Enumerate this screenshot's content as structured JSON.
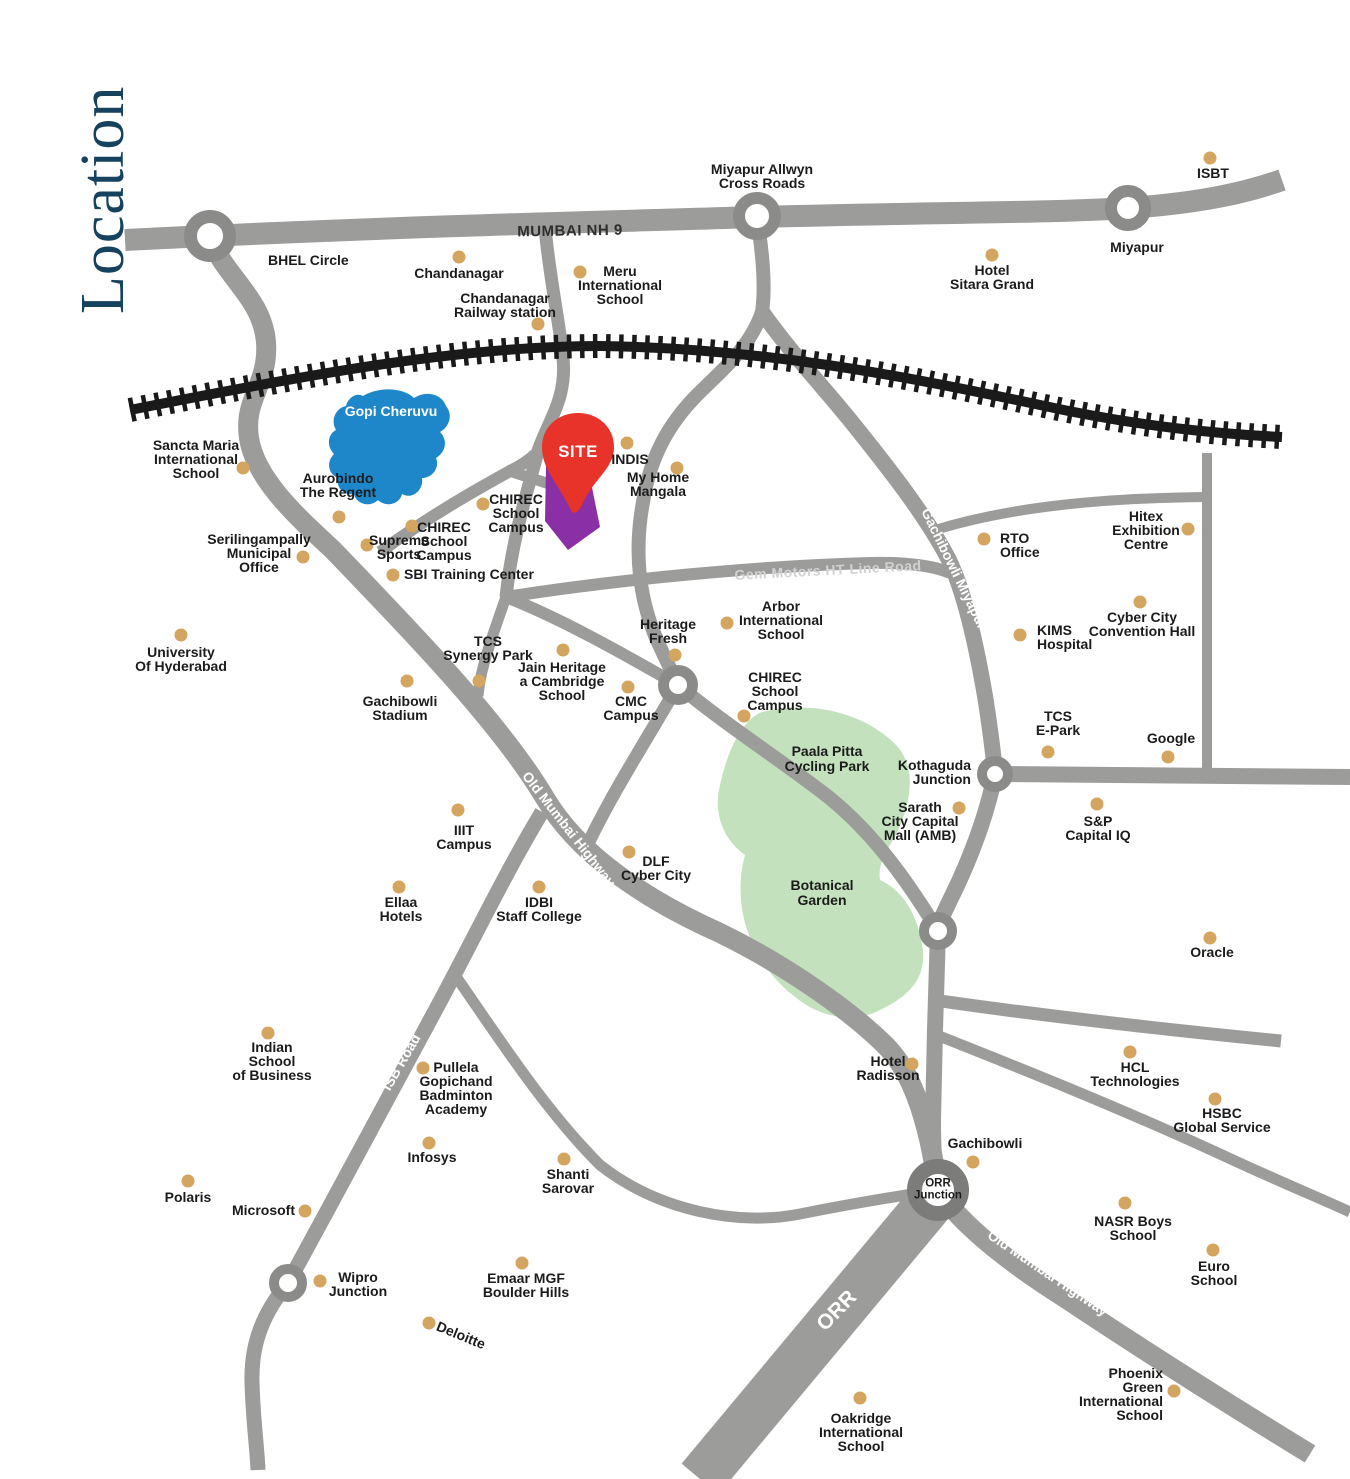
{
  "title": "Location",
  "colors": {
    "road": "#9c9c9b",
    "ring_stroke": "#8b8b8a",
    "railway": "#1a1a1a",
    "lake": "#1d87ca",
    "park": "#c3e1bd",
    "poi_dot": "#d3a55f",
    "site_pin": "#e8332a",
    "site_plot": "#8a2fa5",
    "title_navy": "#16425d"
  },
  "site": {
    "label": "SITE"
  },
  "water": {
    "label": "Gopi Cheruvu",
    "x": 391,
    "y": 404
  },
  "parks": [
    {
      "label": "Paala Pitta\nCycling Park",
      "x": 827,
      "y": 744
    },
    {
      "label": "Botanical\nGarden",
      "x": 822,
      "y": 878
    }
  ],
  "road_labels": [
    {
      "text": "MUMBAI NH 9",
      "x": 570,
      "y": 231,
      "rot": -1,
      "style": "dark",
      "size": 15
    },
    {
      "text": "150 Ft Road",
      "x": 531,
      "y": 416,
      "rot": -74,
      "style": "light",
      "size": 13.5
    },
    {
      "text": "Road No 9",
      "x": 472,
      "y": 478,
      "rot": -27,
      "style": "light",
      "size": 13.5
    },
    {
      "text": "Gem Motors HT Line Road",
      "x": 828,
      "y": 570,
      "rot": -3,
      "style": "faint",
      "size": 14
    },
    {
      "text": "Gachibowli Miyapur Road",
      "x": 963,
      "y": 586,
      "rot": 64,
      "style": "light",
      "size": 14
    },
    {
      "text": "Old Mumbai Highway",
      "x": 569,
      "y": 829,
      "rot": 52,
      "style": "light",
      "size": 14
    },
    {
      "text": "ISB Road",
      "x": 401,
      "y": 1062,
      "rot": -60,
      "style": "light",
      "size": 14
    },
    {
      "text": "ORR",
      "x": 837,
      "y": 1311,
      "rot": -46,
      "style": "light",
      "size": 21
    },
    {
      "text": "Old Mumbai Highway",
      "x": 1048,
      "y": 1273,
      "rot": 34,
      "style": "light",
      "size": 14
    }
  ],
  "junctions": [
    {
      "name": "bhel-circle",
      "x": 210,
      "y": 236,
      "od": 52,
      "bw": 13,
      "label": "BHEL Circle",
      "lx": 268,
      "ly": 253,
      "align": "left"
    },
    {
      "name": "miyapur-allwyn-cross-roads",
      "x": 757,
      "y": 216,
      "od": 48,
      "bw": 12,
      "label": "Miyapur Allwyn\nCross Roads",
      "lx": 762,
      "ly": 162,
      "align": "center"
    },
    {
      "name": "miyapur",
      "x": 1128,
      "y": 208,
      "od": 46,
      "bw": 12,
      "label": "Miyapur",
      "lx": 1137,
      "ly": 240,
      "align": "center"
    },
    {
      "name": "heritage-fresh-junction",
      "x": 678,
      "y": 685,
      "od": 40,
      "bw": 11,
      "label": null
    },
    {
      "name": "kothaguda-junction",
      "x": 995,
      "y": 774,
      "od": 36,
      "bw": 10,
      "label": "Kothaguda\nJunction",
      "lx": 971,
      "ly": 758,
      "align": "right"
    },
    {
      "name": "botanical-junction",
      "x": 938,
      "y": 931,
      "od": 38,
      "bw": 10,
      "label": null
    },
    {
      "name": "wipro-junction-ring",
      "x": 288,
      "y": 1283,
      "od": 38,
      "bw": 10,
      "label": null
    },
    {
      "name": "orr-junction",
      "x": 938,
      "y": 1190,
      "od": 62,
      "bw": 15,
      "label": null,
      "label_inside": "ORR\nJunction"
    }
  ],
  "pois": [
    {
      "label": "Chandanagar",
      "dot": [
        459,
        257
      ],
      "lx": 459,
      "ly": 266,
      "align": "center"
    },
    {
      "label": "Meru\nInternational\nSchool",
      "dot": [
        580,
        272
      ],
      "lx": 620,
      "ly": 264,
      "align": "center"
    },
    {
      "label": "Chandanagar\nRailway station",
      "dot": [
        538,
        324
      ],
      "lx": 505,
      "ly": 291,
      "align": "center"
    },
    {
      "label": "Hotel\nSitara Grand",
      "dot": [
        992,
        255
      ],
      "lx": 992,
      "ly": 263,
      "align": "center"
    },
    {
      "label": "ISBT",
      "dot": [
        1210,
        158
      ],
      "lx": 1213,
      "ly": 166,
      "align": "center"
    },
    {
      "label": "Sancta Maria\nInternational\nSchool",
      "dot": [
        243,
        468
      ],
      "lx": 196,
      "ly": 438,
      "align": "center"
    },
    {
      "label": "Aurobindo\nThe Regent",
      "dot": [
        339,
        517
      ],
      "lx": 338,
      "ly": 471,
      "align": "center"
    },
    {
      "label": "Supreme\nSports",
      "dot": [
        367,
        545
      ],
      "lx": 399,
      "ly": 533,
      "align": "center"
    },
    {
      "label": "CHIREC\nSchool\nCampus",
      "dot": [
        412,
        526
      ],
      "lx": 444,
      "ly": 520,
      "align": "center"
    },
    {
      "label": "CHIREC\nSchool\nCampus",
      "dot": [
        483,
        504
      ],
      "lx": 516,
      "ly": 492,
      "align": "center"
    },
    {
      "label": "SBI Training Center",
      "dot": [
        393,
        575
      ],
      "lx": 404,
      "ly": 567,
      "align": "left"
    },
    {
      "label": "Serilingampally\nMunicipal\nOffice",
      "dot": [
        303,
        557
      ],
      "lx": 259,
      "ly": 532,
      "align": "center"
    },
    {
      "label": "INDIS",
      "dot": [
        627,
        443
      ],
      "lx": 630,
      "ly": 452,
      "align": "center"
    },
    {
      "label": "My Home\nMangala",
      "dot": [
        677,
        468
      ],
      "lx": 658,
      "ly": 470,
      "align": "center"
    },
    {
      "label": "RTO\nOffice",
      "dot": [
        984,
        539
      ],
      "lx": 1000,
      "ly": 531,
      "align": "left"
    },
    {
      "label": "Hitex\nExhibition\nCentre",
      "dot": [
        1188,
        529
      ],
      "lx": 1146,
      "ly": 509,
      "align": "center"
    },
    {
      "label": "KIMS\nHospital",
      "dot": [
        1020,
        635
      ],
      "lx": 1037,
      "ly": 623,
      "align": "left"
    },
    {
      "label": "Cyber City\nConvention Hall",
      "dot": [
        1140,
        602
      ],
      "lx": 1142,
      "ly": 610,
      "align": "center"
    },
    {
      "label": "TCS\nE-Park",
      "dot": [
        1048,
        752
      ],
      "lx": 1058,
      "ly": 709,
      "align": "center"
    },
    {
      "label": "Google",
      "dot": [
        1168,
        757
      ],
      "lx": 1171,
      "ly": 731,
      "align": "center"
    },
    {
      "label": "S&P\nCapital IQ",
      "dot": [
        1097,
        804
      ],
      "lx": 1098,
      "ly": 814,
      "align": "center"
    },
    {
      "label": "University\nOf Hyderabad",
      "dot": [
        181,
        635
      ],
      "lx": 181,
      "ly": 645,
      "align": "center"
    },
    {
      "label": "TCS\nSynergy Park",
      "dot": [
        479,
        681
      ],
      "lx": 488,
      "ly": 634,
      "align": "center"
    },
    {
      "label": "Gachibowli\nStadium",
      "dot": [
        407,
        681
      ],
      "lx": 400,
      "ly": 694,
      "align": "center"
    },
    {
      "label": "Jain Heritage\na Cambridge\nSchool",
      "dot": [
        563,
        650
      ],
      "lx": 562,
      "ly": 660,
      "align": "center"
    },
    {
      "label": "CMC\nCampus",
      "dot": [
        628,
        687
      ],
      "lx": 631,
      "ly": 694,
      "align": "center"
    },
    {
      "label": "Heritage\nFresh",
      "dot": [
        675,
        655
      ],
      "lx": 668,
      "ly": 617,
      "align": "center"
    },
    {
      "label": "CHIREC\nSchool\nCampus",
      "dot": [
        744,
        716
      ],
      "lx": 775,
      "ly": 670,
      "align": "center"
    },
    {
      "label": "Arbor\nInternational\nSchool",
      "dot": [
        727,
        623
      ],
      "lx": 781,
      "ly": 599,
      "align": "center"
    },
    {
      "label": "Sarath\nCity Capital\nMall (AMB)",
      "dot": [
        959,
        808
      ],
      "lx": 920,
      "ly": 800,
      "align": "center"
    },
    {
      "label": "IIIT\nCampus",
      "dot": [
        458,
        810
      ],
      "lx": 464,
      "ly": 823,
      "align": "center"
    },
    {
      "label": "Ellaa\nHotels",
      "dot": [
        399,
        887
      ],
      "lx": 401,
      "ly": 895,
      "align": "center"
    },
    {
      "label": "IDBI\nStaff College",
      "dot": [
        539,
        887
      ],
      "lx": 539,
      "ly": 895,
      "align": "center"
    },
    {
      "label": "DLF\nCyber City",
      "dot": [
        629,
        852
      ],
      "lx": 656,
      "ly": 854,
      "align": "center"
    },
    {
      "label": "Indian\nSchool\nof Business",
      "dot": [
        268,
        1033
      ],
      "lx": 272,
      "ly": 1040,
      "align": "center"
    },
    {
      "label": "Pullela\nGopichand\nBadminton\nAcademy",
      "dot": [
        423,
        1068
      ],
      "lx": 456,
      "ly": 1060,
      "align": "center"
    },
    {
      "label": "Infosys",
      "dot": [
        429,
        1143
      ],
      "lx": 432,
      "ly": 1150,
      "align": "center"
    },
    {
      "label": "Polaris",
      "dot": [
        188,
        1181
      ],
      "lx": 188,
      "ly": 1190,
      "align": "center"
    },
    {
      "label": "Microsoft",
      "dot": [
        305,
        1211
      ],
      "lx": 295,
      "ly": 1203,
      "align": "right"
    },
    {
      "label": "Wipro\nJunction",
      "dot": [
        320,
        1281
      ],
      "lx": 358,
      "ly": 1270,
      "align": "center"
    },
    {
      "label": "Shanti\nSarovar",
      "dot": [
        564,
        1159
      ],
      "lx": 568,
      "ly": 1167,
      "align": "center"
    },
    {
      "label": "Emaar MGF\nBoulder Hills",
      "dot": [
        522,
        1263
      ],
      "lx": 526,
      "ly": 1271,
      "align": "center"
    },
    {
      "label": "Deloitte",
      "dot": [
        429,
        1323
      ],
      "lx": 461,
      "ly": 1328,
      "align": "center",
      "rot": 22
    },
    {
      "label": "Hotel\nRadisson",
      "dot": [
        912,
        1064
      ],
      "lx": 888,
      "ly": 1054,
      "align": "center"
    },
    {
      "label": "Gachibowli",
      "dot": [
        973,
        1162
      ],
      "lx": 985,
      "ly": 1136,
      "align": "center"
    },
    {
      "label": "HCL\nTechnologies",
      "dot": [
        1130,
        1052
      ],
      "lx": 1135,
      "ly": 1060,
      "align": "center"
    },
    {
      "label": "HSBC\nGlobal Service",
      "dot": [
        1215,
        1099
      ],
      "lx": 1222,
      "ly": 1106,
      "align": "center"
    },
    {
      "label": "NASR Boys\nSchool",
      "dot": [
        1125,
        1203
      ],
      "lx": 1133,
      "ly": 1214,
      "align": "center"
    },
    {
      "label": "Euro\nSchool",
      "dot": [
        1213,
        1250
      ],
      "lx": 1214,
      "ly": 1259,
      "align": "center"
    },
    {
      "label": "Oracle",
      "dot": [
        1210,
        938
      ],
      "lx": 1212,
      "ly": 945,
      "align": "center"
    },
    {
      "label": "Oakridge\nInternational\nSchool",
      "dot": [
        860,
        1398
      ],
      "lx": 861,
      "ly": 1411,
      "align": "center"
    },
    {
      "label": "Phoenix\nGreen\nInternational\nSchool",
      "dot": [
        1174,
        1391
      ],
      "lx": 1163,
      "ly": 1366,
      "align": "right"
    }
  ]
}
